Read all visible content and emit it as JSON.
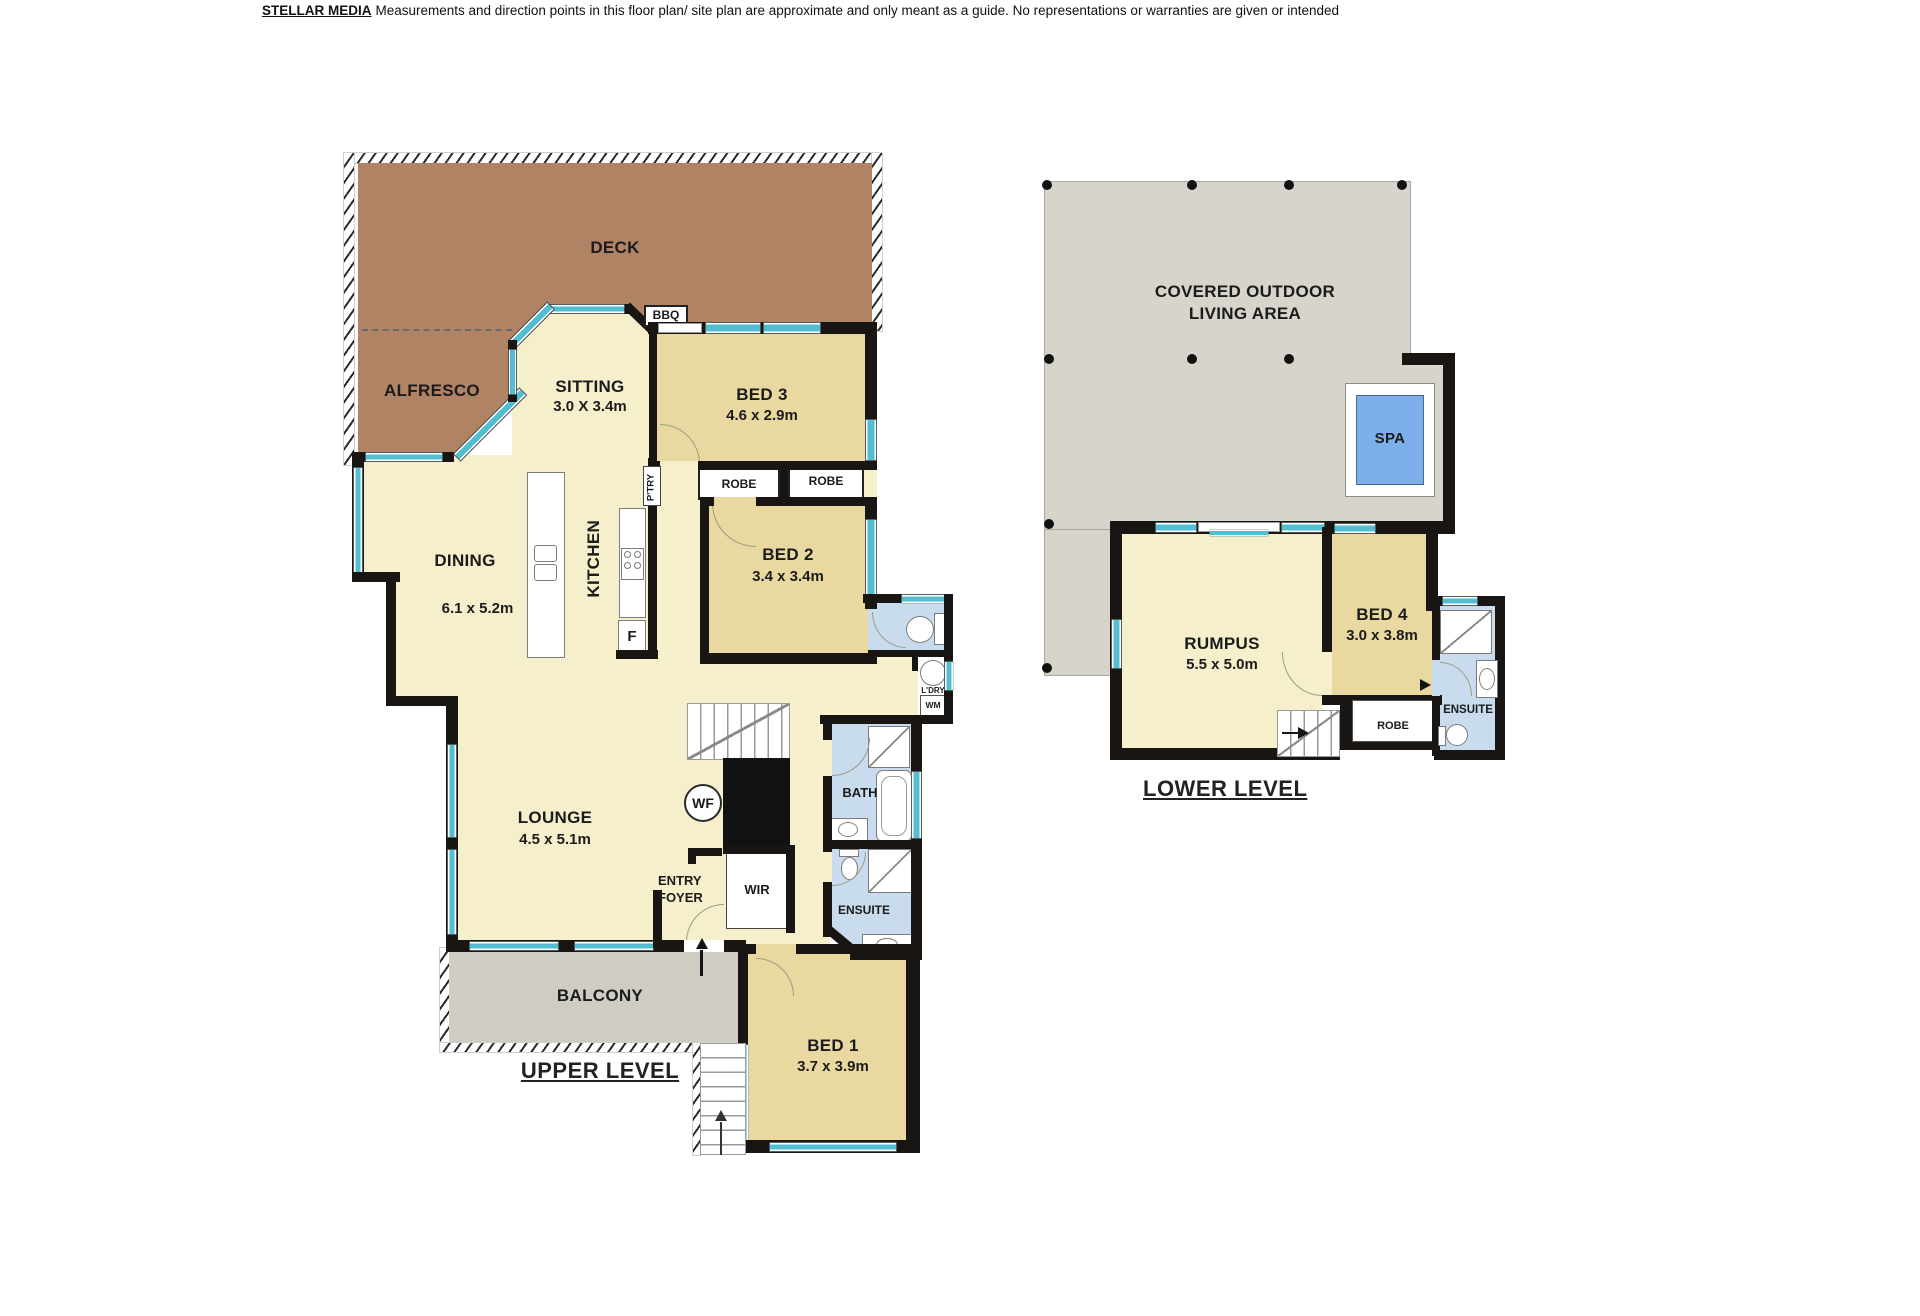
{
  "disclaimer": {
    "brand": "STELLAR MEDIA",
    "text": "Measurements and direction points in this floor plan/ site plan are approximate and only meant as a guide. No representations or warranties are given or intended"
  },
  "upper": {
    "title": "UPPER LEVEL",
    "deck": "DECK",
    "alfresco": "ALFRESCO",
    "bbq": "BBQ",
    "sitting": {
      "name": "SITTING",
      "dims": "3.0 X 3.4m"
    },
    "bed3": {
      "name": "BED 3",
      "dims": "4.6 x 2.9m"
    },
    "robe1": "ROBE",
    "robe2": "ROBE",
    "bed2": {
      "name": "BED 2",
      "dims": "3.4 x 3.4m"
    },
    "dining": {
      "name": "DINING",
      "dims": "6.1 x 5.2m"
    },
    "kitchen": "KITCHEN",
    "ptry": "P'TRY",
    "fridge": "F",
    "ldry": "L'DRY",
    "wm": "WM",
    "bath": "BATH",
    "ensuite": "ENSUITE",
    "lounge": {
      "name": "LOUNGE",
      "dims": "4.5 x 5.1m"
    },
    "wf": "WF",
    "entry": {
      "line1": "ENTRY",
      "line2": "FOYER"
    },
    "wir": "WIR",
    "balcony": "BALCONY",
    "bed1": {
      "name": "BED 1",
      "dims": "3.7 x 3.9m"
    }
  },
  "lower": {
    "title": "LOWER LEVEL",
    "outdoor": {
      "line1": "COVERED OUTDOOR",
      "line2": "LIVING AREA"
    },
    "spa": "SPA",
    "rumpus": {
      "name": "RUMPUS",
      "dims": "5.5 x 5.0m"
    },
    "bed4": {
      "name": "BED 4",
      "dims": "3.0 x 3.8m"
    },
    "ensuite": "ENSUITE",
    "robe": "ROBE"
  },
  "colors": {
    "wall": "#181512",
    "window": "#53bdd2",
    "living": "#f5efcc",
    "bedroom": "#e9d9a1",
    "wet_area": "#c9dcee",
    "deck": "#b18365",
    "balcony": "#cfccc3",
    "outdoor": "#d7d4cc",
    "spa": "#7db0ea"
  }
}
